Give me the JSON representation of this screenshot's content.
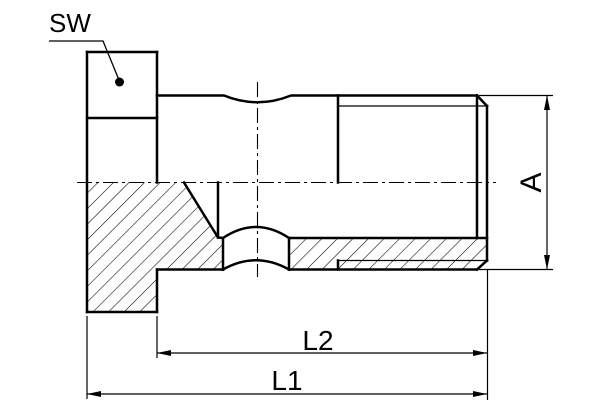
{
  "drawing": {
    "type": "technical-drawing",
    "part": "banjo-bolt-half-section",
    "colors": {
      "line": "#000000",
      "background": "#ffffff"
    },
    "labels": {
      "wrench_size": "SW",
      "diameter": "A",
      "length_partial": "L2",
      "length_total": "L1"
    },
    "dimensions": [
      {
        "label": "SW",
        "style": "leader-with-dot",
        "target": "hex-head"
      },
      {
        "label": "A",
        "style": "vertical-dimension",
        "target": "thread-outer-diameter"
      },
      {
        "label": "L2",
        "style": "horizontal-dimension",
        "target": "shank-length"
      },
      {
        "label": "L1",
        "style": "horizontal-dimension",
        "target": "overall-length"
      }
    ]
  }
}
